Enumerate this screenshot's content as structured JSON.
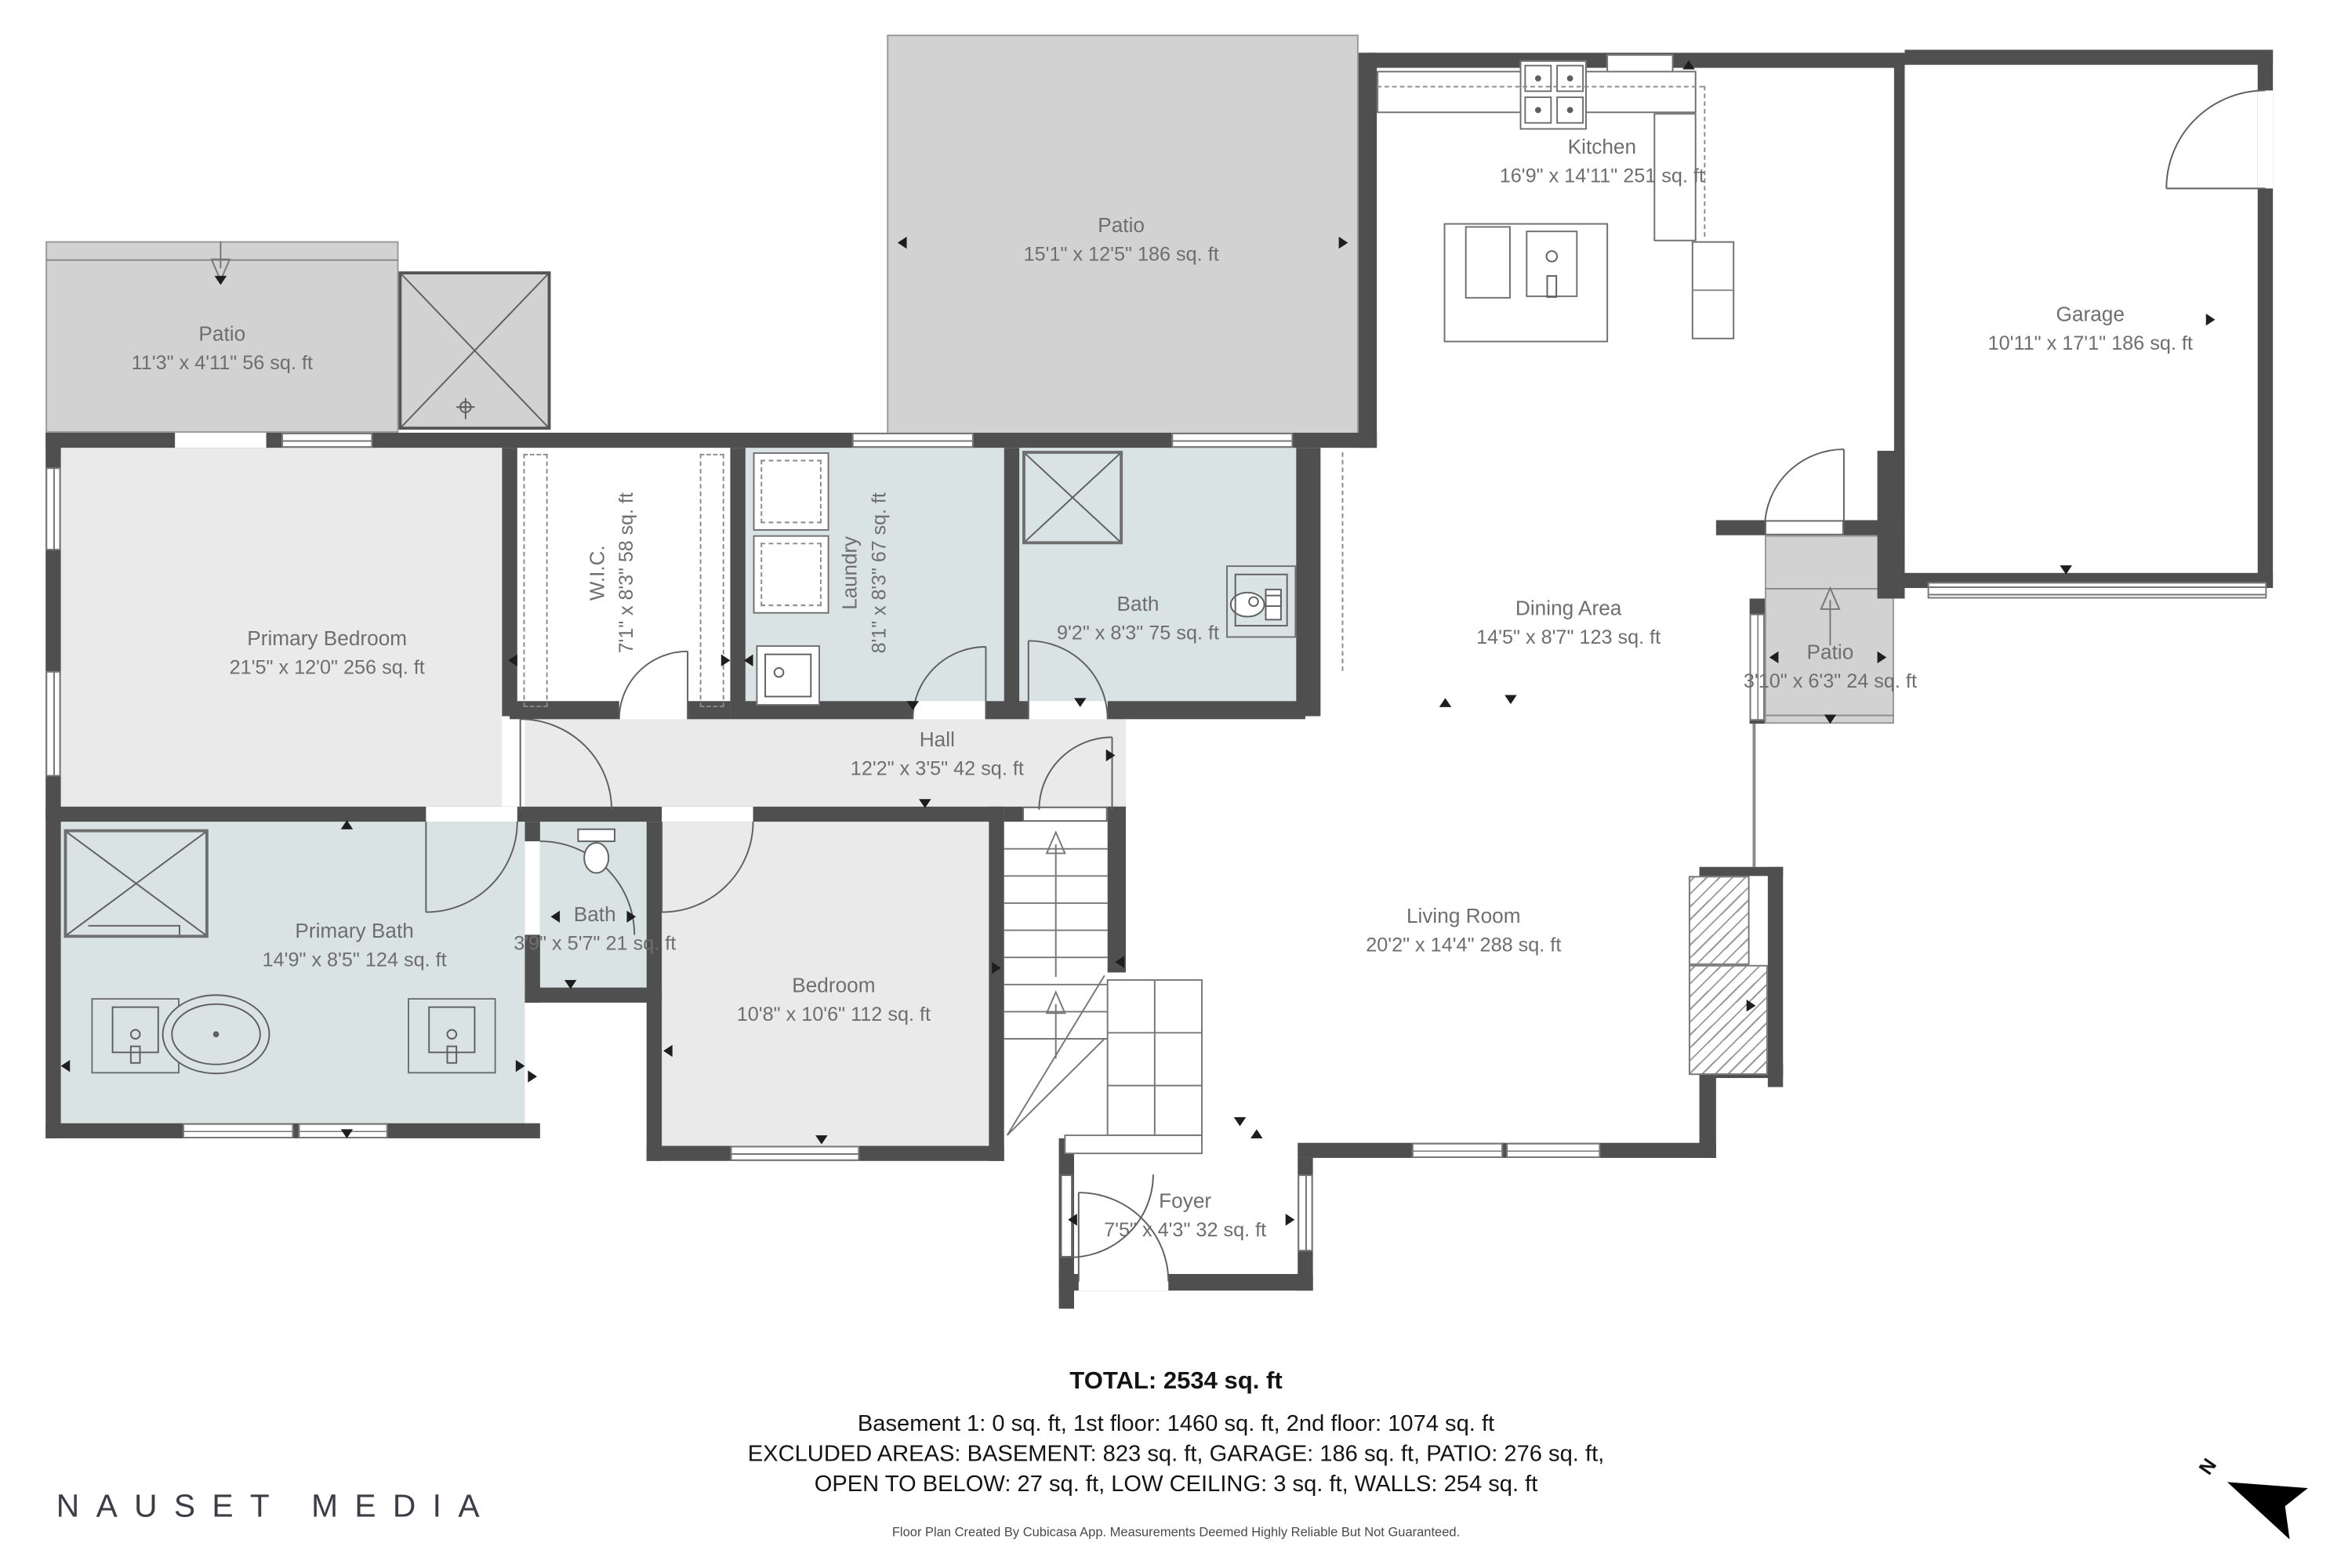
{
  "rooms": {
    "patio_tl": {
      "name": "Patio",
      "dims": "11'3\" x 4'11\" 56 sq. ft"
    },
    "patio_tm": {
      "name": "Patio",
      "dims": "15'1\" x 12'5\" 186 sq. ft"
    },
    "kitchen": {
      "name": "Kitchen",
      "dims": "16'9\" x 14'11\" 251 sq. ft"
    },
    "garage": {
      "name": "Garage",
      "dims": "10'11\" x 17'1\" 186 sq. ft"
    },
    "primary_bedroom": {
      "name": "Primary Bedroom",
      "dims": "21'5\" x 12'0\" 256 sq. ft"
    },
    "wic": {
      "name": "W.I.C.",
      "dims": "7'1\" x 8'3\" 58 sq. ft"
    },
    "laundry": {
      "name": "Laundry",
      "dims": "8'1\" x 8'3\" 67 sq. ft"
    },
    "bath_m": {
      "name": "Bath",
      "dims": "9'2\" x 8'3\" 75 sq. ft"
    },
    "dining": {
      "name": "Dining Area",
      "dims": "14'5\" x 8'7\" 123 sq. ft"
    },
    "patio_r": {
      "name": "Patio",
      "dims": "3'10\" x 6'3\" 24 sq. ft"
    },
    "hall": {
      "name": "Hall",
      "dims": "12'2\" x 3'5\" 42 sq. ft"
    },
    "primary_bath": {
      "name": "Primary Bath",
      "dims": "14'9\" x 8'5\" 124 sq. ft"
    },
    "bath_s": {
      "name": "Bath",
      "dims": "3'9\" x 5'7\" 21 sq. ft"
    },
    "bedroom2": {
      "name": "Bedroom",
      "dims": "10'8\" x 10'6\" 112 sq. ft"
    },
    "living": {
      "name": "Living Room",
      "dims": "20'2\" x 14'4\" 288 sq. ft"
    },
    "foyer": {
      "name": "Foyer",
      "dims": "7'5\" x 4'3\" 32 sq. ft"
    }
  },
  "footer": {
    "total": "TOTAL: 2534 sq. ft",
    "floors": "Basement 1: 0 sq. ft, 1st floor: 1460 sq. ft, 2nd floor: 1074 sq. ft",
    "excluded1": "EXCLUDED AREAS: BASEMENT: 823 sq. ft, GARAGE: 186 sq. ft, PATIO: 276 sq. ft,",
    "excluded2": "OPEN TO BELOW: 27 sq. ft, LOW CEILING: 3 sq. ft, WALLS: 254 sq. ft",
    "disclaimer": "Floor Plan Created By Cubicasa App. Measurements Deemed Highly Reliable But Not Guaranteed."
  },
  "branding": {
    "logo": "NAUSET MEDIA"
  },
  "compass": {
    "north_label": "N"
  },
  "colors": {
    "wall": "#4f4f4f",
    "patio_fill": "#d2d2d2",
    "bath_fill": "#d9e3e3",
    "room_fill": "#eaeaea",
    "label_text": "#6e6e6e"
  }
}
